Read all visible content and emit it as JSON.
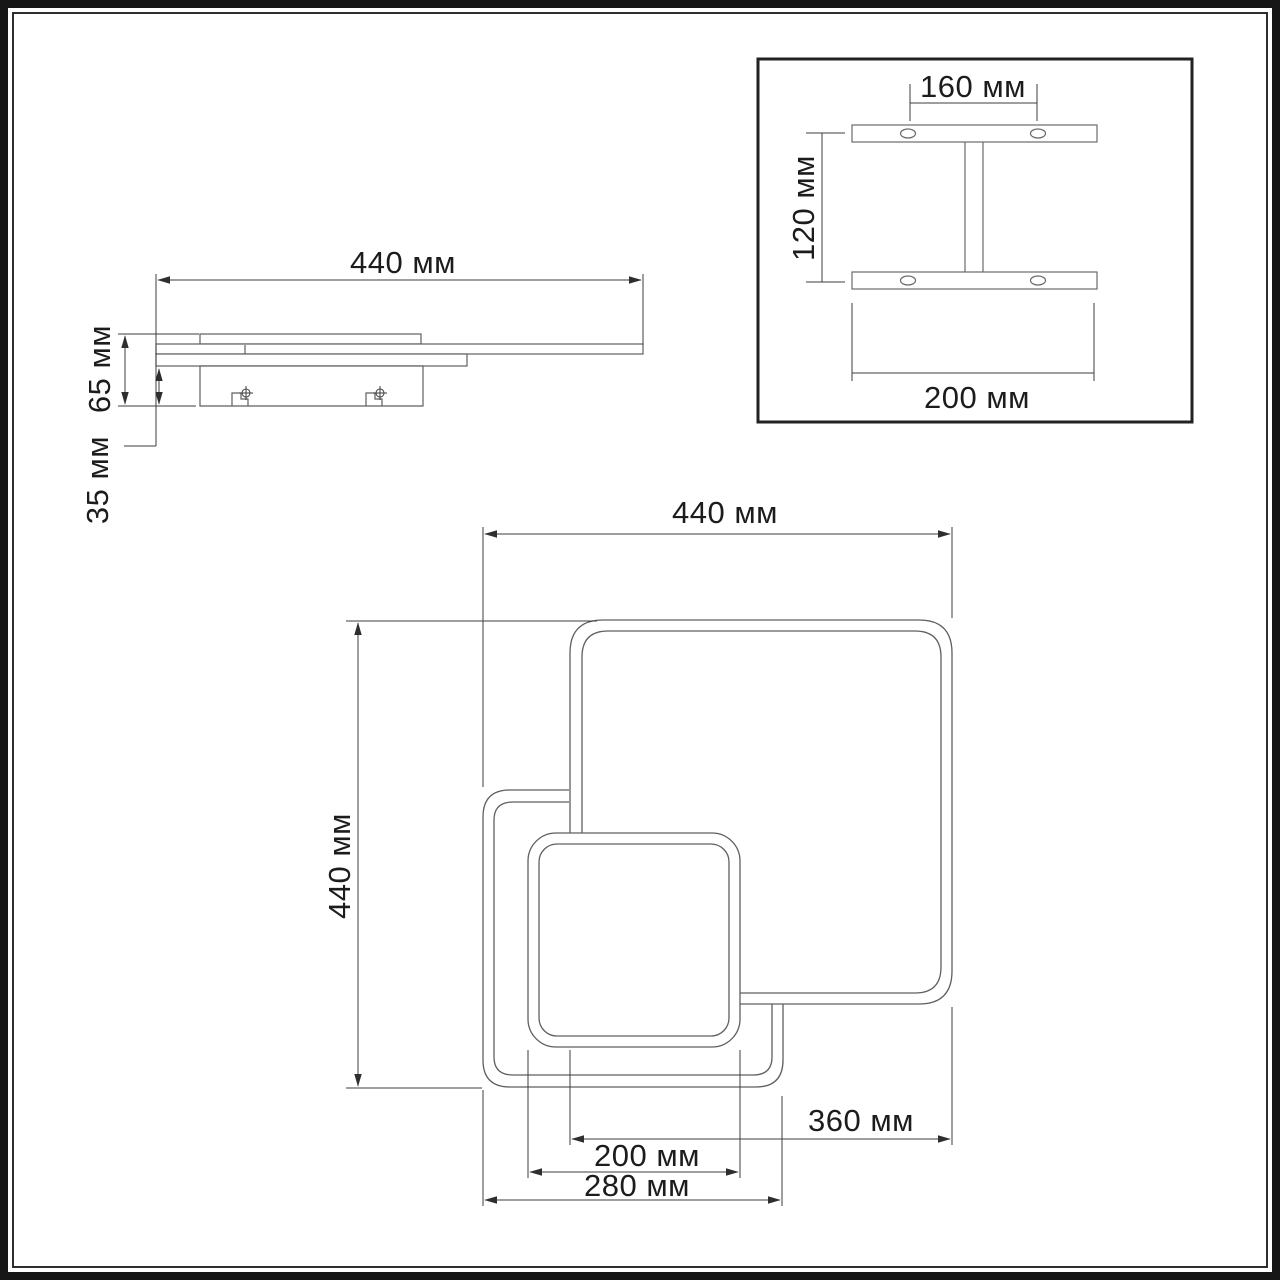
{
  "drawing": {
    "type": "technical-dimension-drawing",
    "unit": "мм",
    "side_view": {
      "width_label": "440 мм",
      "width_value": 440,
      "total_height_label": "65 мм",
      "total_height_value": 65,
      "canopy_height_label": "35 мм",
      "canopy_height_value": 35
    },
    "bracket_detail": {
      "holes_spacing_label": "160 мм",
      "holes_spacing_value": 160,
      "bracket_height_label": "120 мм",
      "bracket_height_value": 120,
      "bracket_width_label": "200 мм",
      "bracket_width_value": 200
    },
    "plan_view": {
      "overall_width_label": "440 мм",
      "overall_width_value": 440,
      "overall_height_label": "440 мм",
      "overall_height_value": 440,
      "large_square_label": "360 мм",
      "large_square_value": 360,
      "small_square_label": "200 мм",
      "small_square_value": 200,
      "medium_square_label": "280 мм",
      "medium_square_value": 280
    },
    "colors": {
      "background": "#ffffff",
      "frame": "#1a1a1a",
      "shape_line": "#5f5f5f",
      "dim_line": "#3d3d3d",
      "text": "#1c1c1c"
    }
  }
}
